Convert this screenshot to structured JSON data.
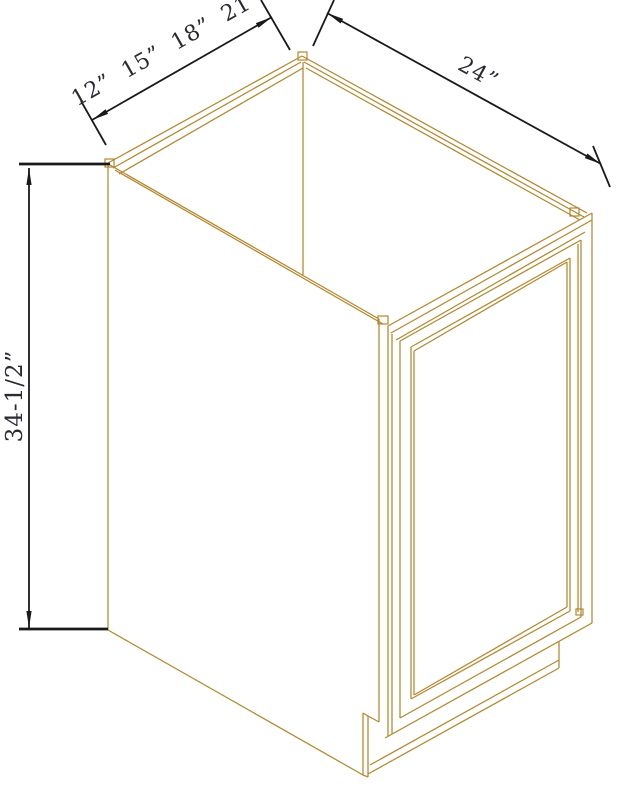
{
  "figure": {
    "name": "base-cabinet-isometric-drawing"
  },
  "dimensions": {
    "width_options": {
      "label": "12” 15” 18” 21”",
      "values_inches": [
        12,
        15,
        18,
        21
      ]
    },
    "depth": {
      "label": "24”",
      "value_inches": 24
    },
    "height": {
      "label": "34-1/2”",
      "value_inches": 34.5
    }
  },
  "colors": {
    "cabinet_line": "#b4872d",
    "dimension_line": "#1a1a1a",
    "dimension_text": "#2a2a33",
    "background": "#ffffff"
  }
}
